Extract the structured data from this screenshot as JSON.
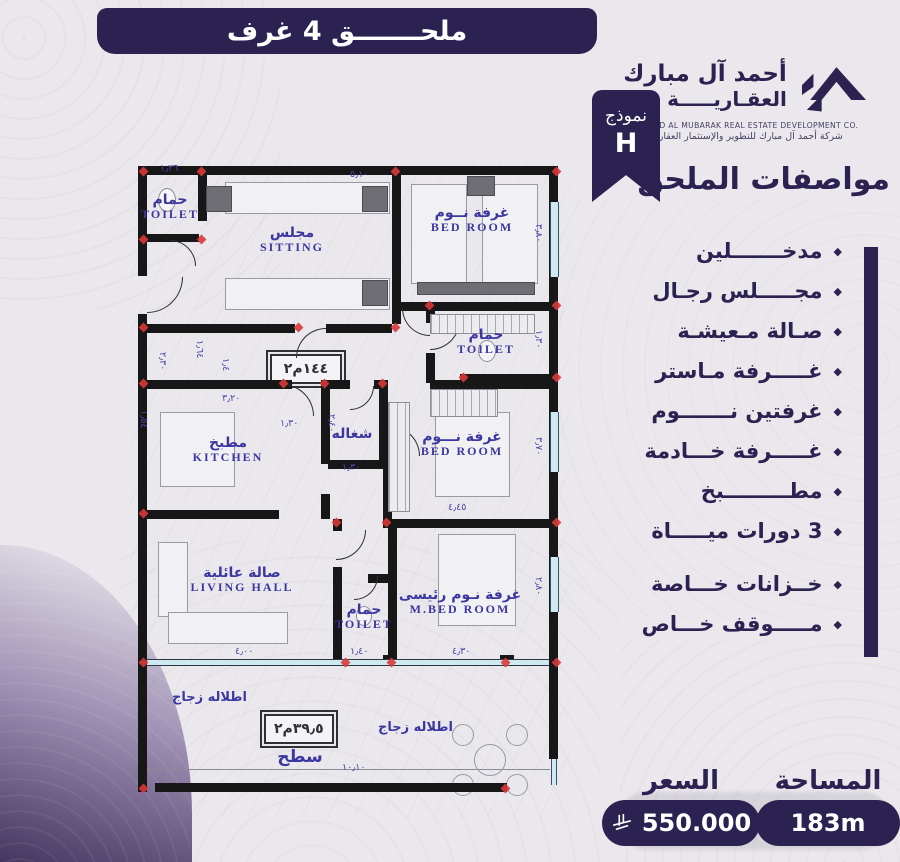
{
  "page": {
    "bg": "#eae8ec",
    "accent": "#2b2251",
    "plan_label_color": "#3b37a0",
    "marker_red": "#d93838"
  },
  "banner": {
    "title": "ملحـــــــق 4 غرف"
  },
  "brand": {
    "logo_icon": "house-roof-icon",
    "name_ar_1": "أحمد آل مبارك",
    "name_ar_2": "العقـاريـــــة",
    "name_en": "AHMED AL MUBARAK REAL ESTATE DEVELOPMENT CO.",
    "tagline_ar": "شركة أحمد آل مبارك للتطوير والإستثمار العقاري"
  },
  "model_badge": {
    "label": "نموذج",
    "value": "H"
  },
  "specs": {
    "heading": "مواصفات الملحق",
    "bullet_icon": "diamond-bullet-icon",
    "items": [
      "مدخـــــــلين",
      "مجـــــلس رجـال",
      "صـالة مـعيشـة",
      "غـــــرفة مـاستر",
      "غرفتين نـــــــوم",
      "غـــــرفة خـــادمة",
      "مطـــــــــبخ",
      "3 دورات ميـــــاة",
      "خــزانات خـــاصة",
      "مـــــوقف خـــاص"
    ]
  },
  "footer": {
    "price_label": "السعر",
    "price_value": "550.000",
    "currency_icon": "saudi-riyal-icon",
    "area_label": "المساحة",
    "area_value": "183m"
  },
  "floorplan": {
    "badge_main": "١٤٤م٢",
    "badge_roof": "٣٩٫٥م٢",
    "glass_label_1": "اطلاله زجاج",
    "glass_label_2": "اطلاله زجاج",
    "rooms": [
      {
        "key": "toilet-top",
        "ar": "حمام",
        "en": "TOILET",
        "x": 40,
        "y": 45
      },
      {
        "key": "sitting",
        "ar": "مجلس",
        "en": "SITTING",
        "x": 162,
        "y": 78
      },
      {
        "key": "bedroom-top",
        "ar": "غرفة نــوم",
        "en": "BED ROOM",
        "x": 342,
        "y": 58
      },
      {
        "key": "toilet-mid",
        "ar": "حمام",
        "en": "TOILET",
        "x": 356,
        "y": 180
      },
      {
        "key": "kitchen",
        "ar": "مطبخ",
        "en": "KITCHEN",
        "x": 98,
        "y": 288
      },
      {
        "key": "maid-room",
        "ar": "شغاله",
        "en": "",
        "x": 222,
        "y": 272
      },
      {
        "key": "bedroom-mid",
        "ar": "غرفة نـــوم",
        "en": "BED ROOM",
        "x": 332,
        "y": 282
      },
      {
        "key": "living-hall",
        "ar": "صالة عائلية",
        "en": "LIVING HALL",
        "x": 112,
        "y": 418
      },
      {
        "key": "toilet-bottom",
        "ar": "حمام",
        "en": "TOILET",
        "x": 234,
        "y": 455
      },
      {
        "key": "master-bedroom",
        "ar": "غرفة نـوم رئيسى",
        "en": "M.BED ROOM",
        "x": 330,
        "y": 440
      },
      {
        "key": "roof-terrace",
        "ar": "سطح",
        "en": "",
        "x": 170,
        "y": 596
      }
    ],
    "dims": [
      {
        "t": "١٫٣٦",
        "x": 30,
        "y": 1,
        "v": 0
      },
      {
        "t": "٥٫١٠",
        "x": 220,
        "y": 7,
        "v": 0
      },
      {
        "t": "٣٫٨٠",
        "x": 403,
        "y": 62,
        "v": 1
      },
      {
        "t": "١٫٣٠",
        "x": 403,
        "y": 168,
        "v": 1
      },
      {
        "t": "٣٫٧٠",
        "x": 403,
        "y": 275,
        "v": 1
      },
      {
        "t": "٢٫٨٠",
        "x": 403,
        "y": 415,
        "v": 1
      },
      {
        "t": "١٫٦٤",
        "x": 64,
        "y": 178,
        "v": 1
      },
      {
        "t": "٢٫٣٠",
        "x": 27,
        "y": 190,
        "v": 1
      },
      {
        "t": "١٫٥٤",
        "x": 8,
        "y": 248,
        "v": 1
      },
      {
        "t": "١٫٤",
        "x": 90,
        "y": 196,
        "v": 1
      },
      {
        "t": "٣٫٢٠",
        "x": 92,
        "y": 231,
        "v": 0
      },
      {
        "t": "١٫٣٠",
        "x": 150,
        "y": 256,
        "v": 0
      },
      {
        "t": "٢٫٤٠",
        "x": 196,
        "y": 252,
        "v": 1
      },
      {
        "t": "١٫٣٠",
        "x": 212,
        "y": 300,
        "v": 0
      },
      {
        "t": "٤٫٤٥",
        "x": 318,
        "y": 340,
        "v": 0
      },
      {
        "t": "٤٫٠٠",
        "x": 105,
        "y": 484,
        "v": 0
      },
      {
        "t": "١٫٤٠",
        "x": 220,
        "y": 484,
        "v": 0
      },
      {
        "t": "٤٫٣٠",
        "x": 322,
        "y": 484,
        "v": 0
      },
      {
        "t": "١٠٫١٠",
        "x": 212,
        "y": 600,
        "v": 0
      }
    ]
  }
}
